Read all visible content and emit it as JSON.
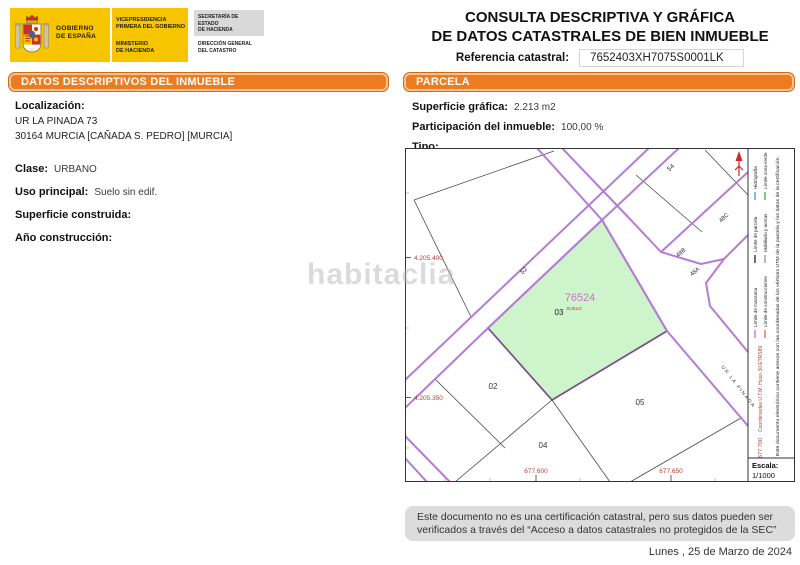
{
  "header": {
    "logo": {
      "gov1": "GOBIERNO",
      "gov2": "DE ESPAÑA",
      "vice1": "VICEPRESIDENCIA",
      "vice2": "PRIMERA DEL GOBIERNO",
      "min1": "MINISTERIO",
      "min2": "DE HACIENDA",
      "sec1": "SECRETARÍA DE ESTADO",
      "sec2": "DE HACIENDA",
      "dir1": "DIRECCIÓN GENERAL",
      "dir2": "DEL CATASTRO"
    },
    "title_line1": "CONSULTA DESCRIPTIVA Y GRÁFICA",
    "title_line2": "DE DATOS CATASTRALES DE BIEN INMUEBLE",
    "ref_label": "Referencia catastral:",
    "ref_value": "7652403XH7075S0001LK"
  },
  "left_panel": {
    "header": "DATOS DESCRIPTIVOS DEL INMUEBLE",
    "localizacion_label": "Localización:",
    "address_line1": "UR LA PINADA 73",
    "address_line2": "30164 MURCIA [CAÑADA S. PEDRO] [MURCIA]",
    "fields": [
      {
        "label": "Clase:",
        "value": "URBANO"
      },
      {
        "label": "Uso principal:",
        "value": "Suelo sin edif."
      },
      {
        "label": "Superficie construida:",
        "value": ""
      },
      {
        "label": "Año construcción:",
        "value": ""
      }
    ]
  },
  "parcel_panel": {
    "header": "PARCELA",
    "fields": [
      {
        "label": "Superficie gráfica:",
        "value": "2.213 m2"
      },
      {
        "label": "Participación del inmueble:",
        "value": "100,00 %"
      },
      {
        "label": "Tipo:",
        "value": ""
      }
    ]
  },
  "map": {
    "subject_parcel": {
      "number": "76524",
      "sub": "03",
      "use": "SUELO"
    },
    "parcels": {
      "p02": "02",
      "p04": "04",
      "p05": "05"
    },
    "streets": {
      "n52": "52",
      "n54": "54",
      "n48a": "48A",
      "n48b": "48B",
      "n48c": "48C",
      "street_name": "UR LA PINADA"
    },
    "coords": {
      "y1": "4.205.400",
      "y2": "4.205.350",
      "x1": "677.600",
      "x2": "677.650",
      "x3": "677.700"
    },
    "legend": {
      "coord_note": "Coordenadas U.T.M. Huso 30 ETRS89",
      "doc_note": "Este documento electrónico contiene anexos con las coordenadas de los vértices UTM de la parcela y los datos de la certificación.",
      "items": [
        {
          "label": "Límite de manzana",
          "color": "#b57bd5"
        },
        {
          "label": "Límite de construcciones",
          "color": "#d4764a"
        },
        {
          "label": "Límite de parcela",
          "color": "#333333"
        },
        {
          "label": "Mobiliario y aceras",
          "color": "#999999"
        },
        {
          "label": "Hidrografía",
          "color": "#5b9bd5"
        },
        {
          "label": "Límite zona verde",
          "color": "#55aa55"
        }
      ],
      "escala_label": "Escala:",
      "escala_value": "1/1000"
    }
  },
  "watermark": "habitaclia",
  "footer": {
    "disclaimer": "Este documento no es una certificación catastral, pero sus datos pueden ser verificados a través del “Acceso a datos catastrales no protegidos de la SEC”",
    "date": "Lunes , 25 de Marzo de 2024"
  },
  "colors": {
    "accent_orange": "#ED7C1E",
    "logo_yellow": "#F6C500",
    "parcel_green": "#CDF4CB",
    "street_purple": "#B57BD5",
    "coord_red": "#B5403A",
    "parcel_number_pink": "#CF6ED0",
    "footer_gray": "#DCDCDC"
  }
}
